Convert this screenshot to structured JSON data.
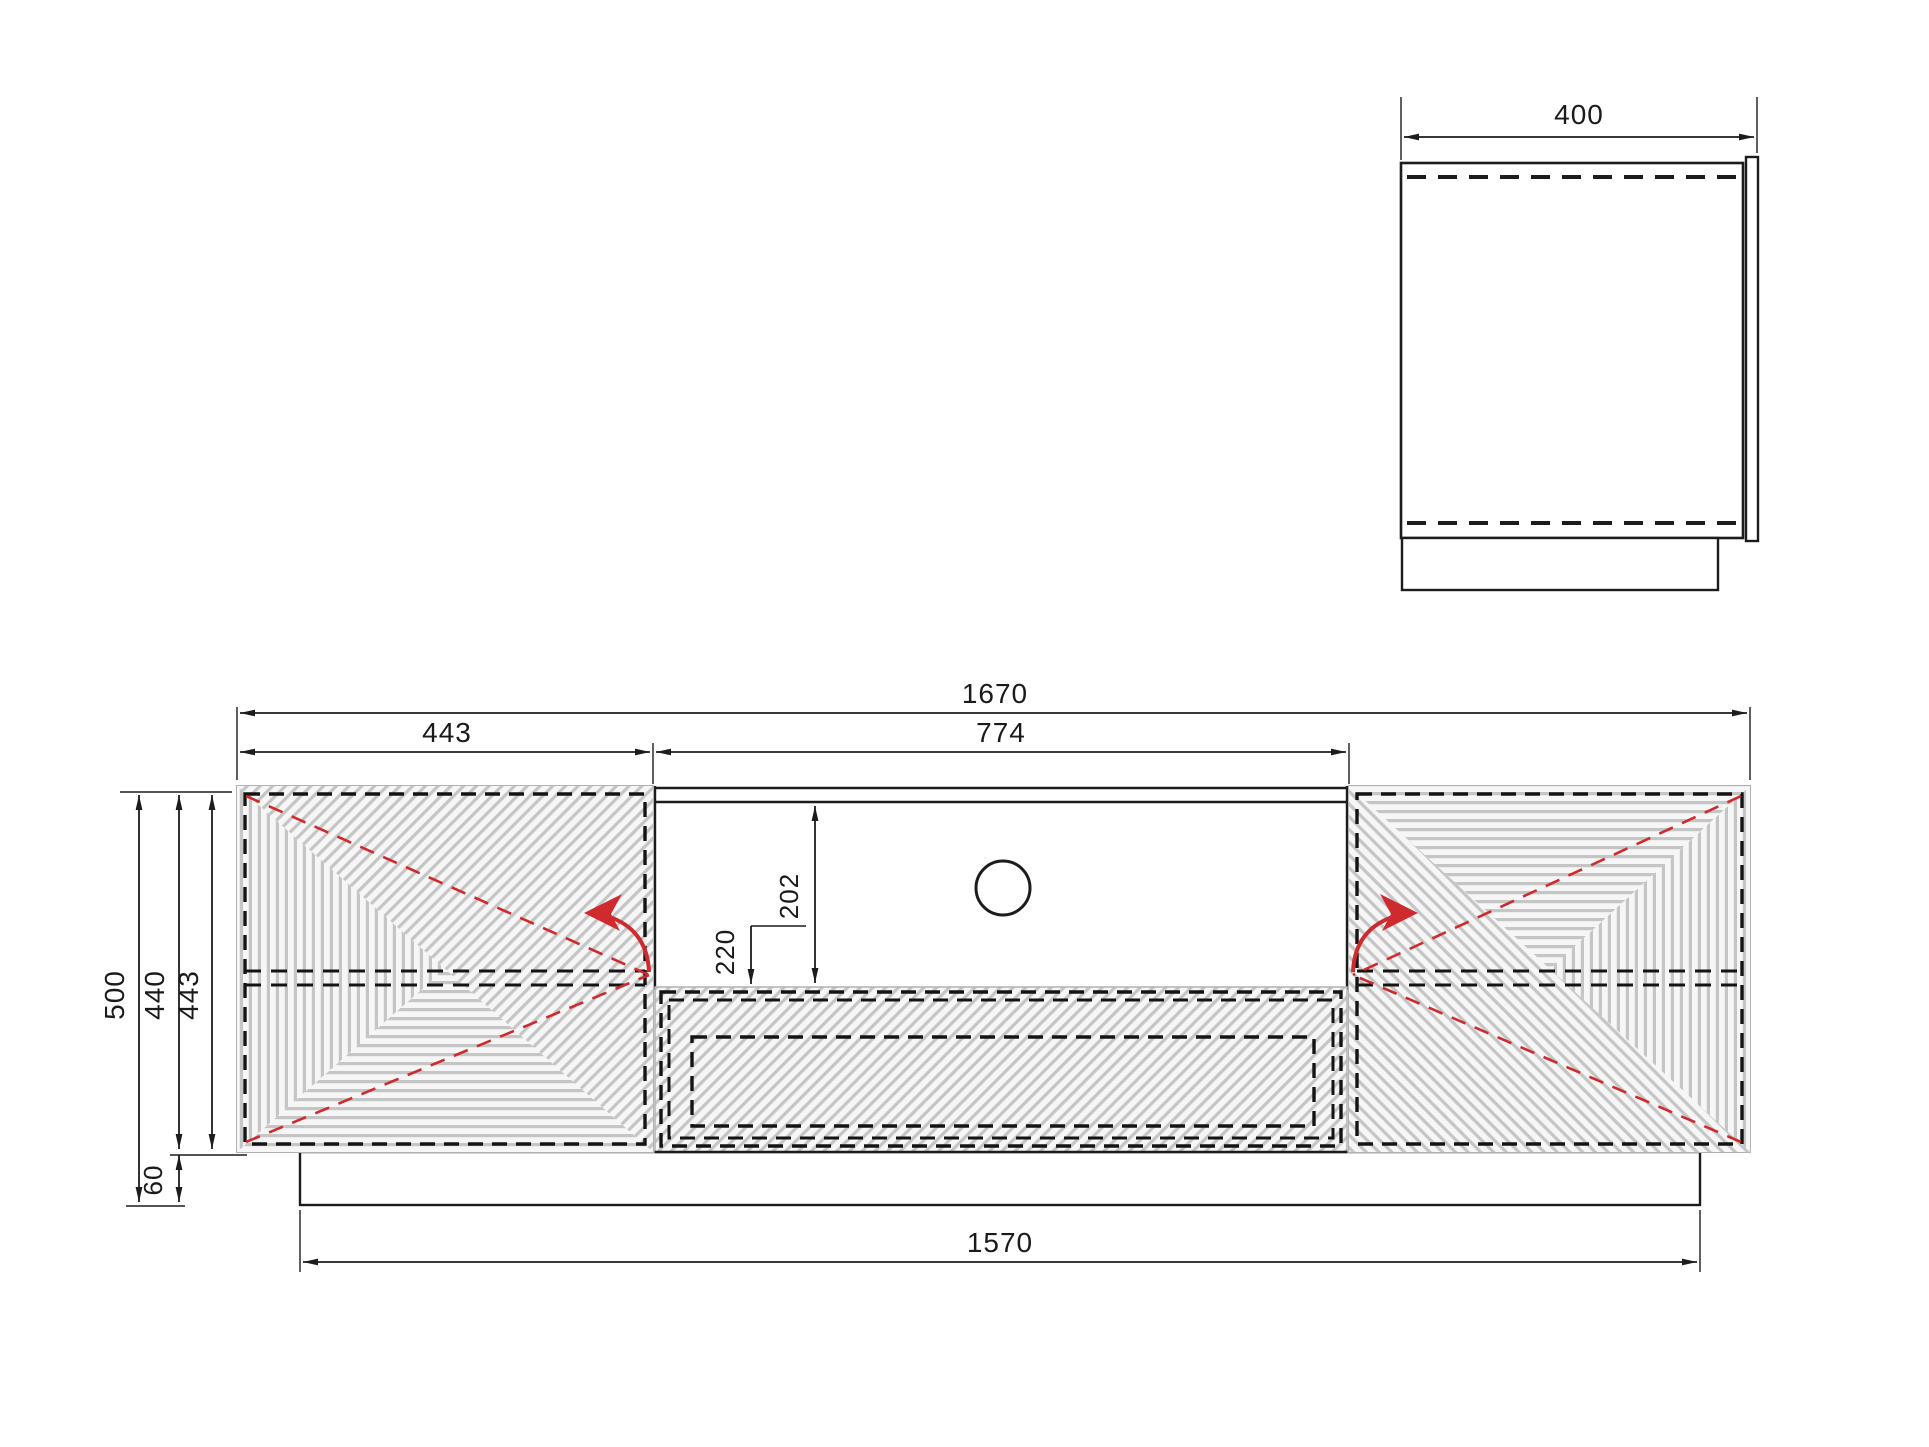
{
  "front_view": {
    "total_width": "1670",
    "door_width": "443",
    "niche_width": "774",
    "total_height": "500",
    "carcass_height": "440",
    "door_height": "443",
    "plinth_height": "60",
    "plinth_width": "1570",
    "niche_opening_height": "202",
    "bottom_panel_offset": "220"
  },
  "side_view": {
    "depth": "400"
  },
  "colors": {
    "outline": "#1c1c1c",
    "dash_black": "#141414",
    "hatch_line": "#c5c5c5",
    "hatch_bg": "#f6f6f6",
    "door_edge": "#b2b2b2",
    "swing_red": "#cf2a2e"
  }
}
